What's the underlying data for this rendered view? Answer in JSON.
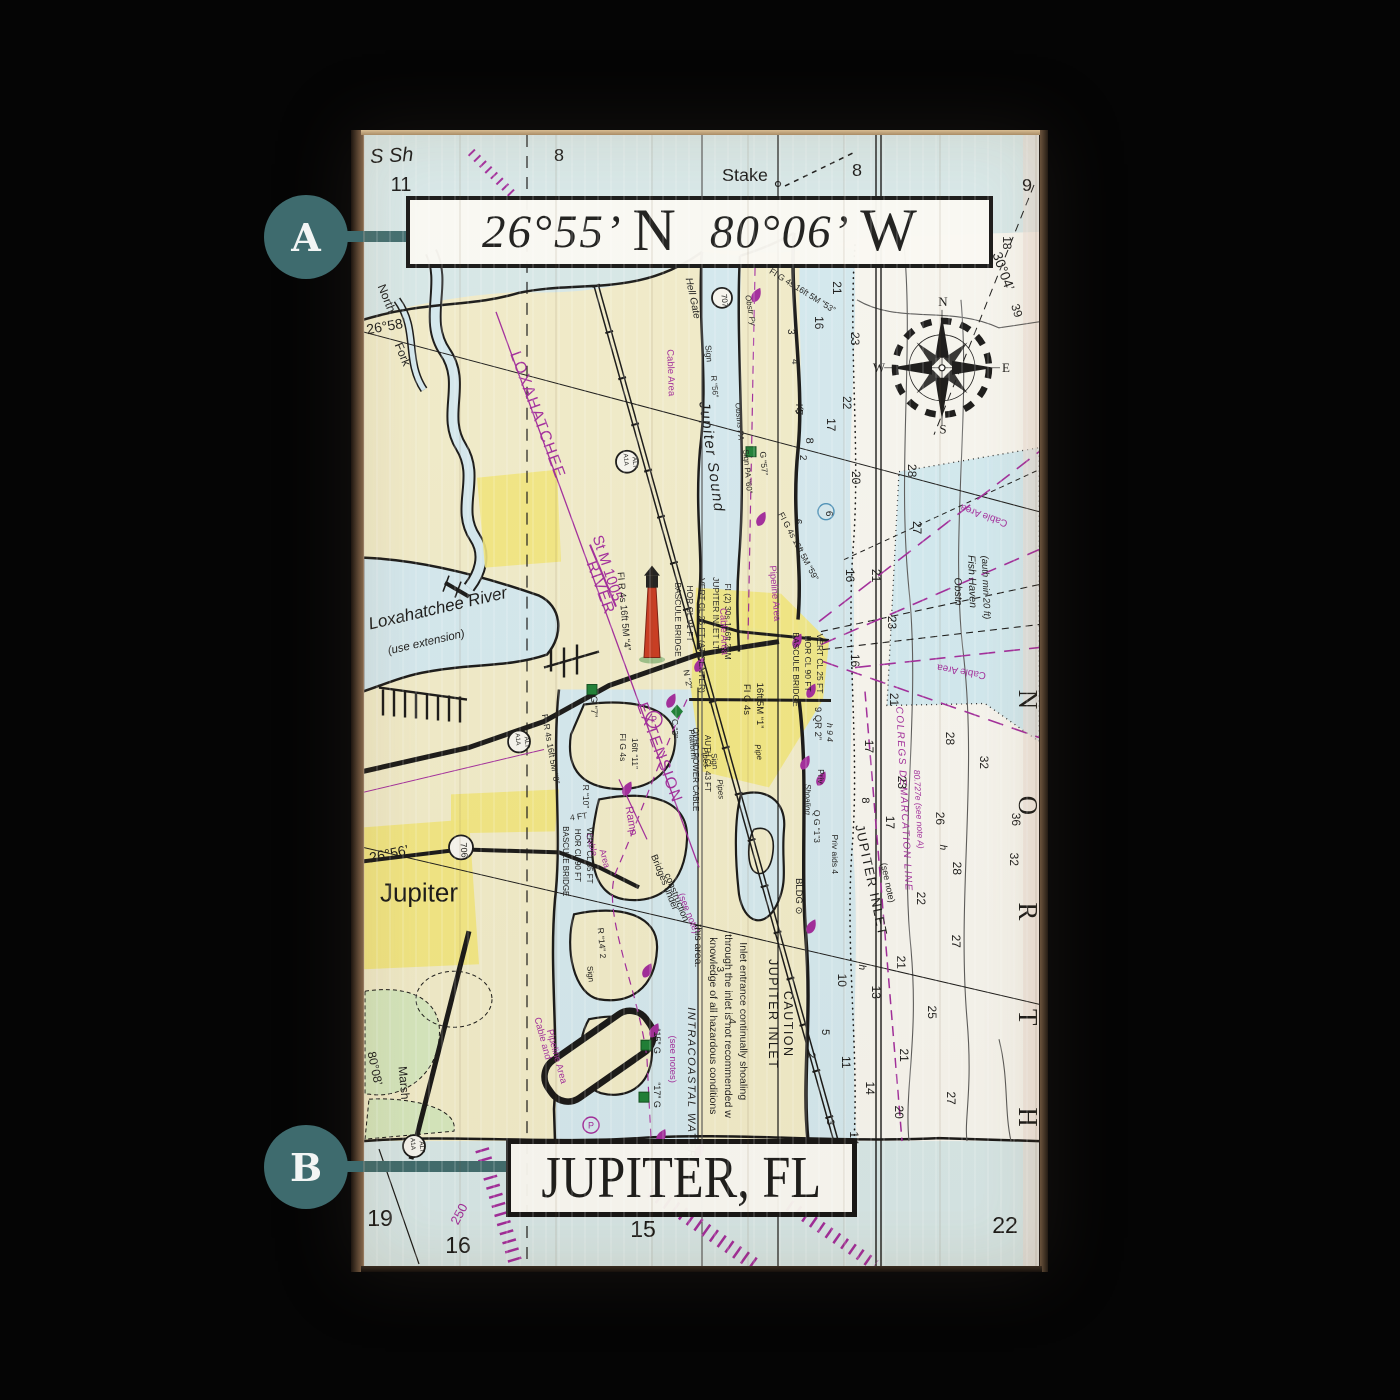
{
  "scene": {
    "background": "#050505"
  },
  "callouts": {
    "color": "#3E6B6E",
    "a": {
      "label": "A"
    },
    "b": {
      "label": "B"
    }
  },
  "banners": {
    "coordinates": {
      "latitude": "26°55’",
      "latitude_hemisphere": "N",
      "longitude": "80°06’",
      "longitude_hemisphere": "W"
    },
    "city": "JUPITER, FL"
  },
  "chart": {
    "colors": {
      "land": "#f1ecca",
      "water": "#d7e8e9",
      "shallow": "#d4e9f0",
      "white-field": "#f7f6f0",
      "yellow": "#f2e77c",
      "marsh": "#d6e8bf",
      "cable-cyan": "#cfeaf2",
      "magenta": "#a12a9c",
      "ink": "#161616",
      "lighthouse-red": "#c9381f",
      "buoy-green": "#1b7f35",
      "callout": "#3E6B6E"
    },
    "labels": [
      [
        "S Sh",
        393,
        162,
        -3,
        20,
        "i"
      ],
      [
        "11",
        402,
        191,
        0,
        20,
        ""
      ],
      [
        "8",
        560,
        161,
        0,
        18,
        ""
      ],
      [
        "Stake",
        746,
        181,
        0,
        18,
        ""
      ],
      [
        "8",
        858,
        176,
        0,
        18,
        ""
      ],
      [
        "9",
        1028,
        191,
        0,
        18,
        ""
      ],
      [
        "18",
        1004,
        243,
        90,
        12,
        ""
      ],
      [
        "30°04’",
        1000,
        273,
        70,
        14,
        ""
      ],
      [
        "39",
        1014,
        312,
        72,
        12,
        ""
      ],
      [
        "26°58’",
        388,
        331,
        -10,
        14,
        ""
      ],
      [
        "North",
        384,
        300,
        68,
        12,
        ""
      ],
      [
        "Fork",
        400,
        356,
        68,
        12,
        ""
      ],
      [
        "Hell Gate",
        691,
        299,
        78,
        10,
        "i"
      ],
      [
        "707",
        723,
        301,
        85,
        8,
        ""
      ],
      [
        "Obstr Py",
        749,
        311,
        80,
        8,
        "i"
      ],
      [
        "Sign",
        707,
        354,
        85,
        8.5,
        ""
      ],
      [
        "R “56”",
        713,
        387,
        85,
        8,
        ""
      ],
      [
        "Obstns PA",
        738,
        422,
        85,
        8,
        "i"
      ],
      [
        "FI G 4s 16ft 5M “53”",
        802,
        293,
        32,
        8.5,
        ""
      ],
      [
        "Cable Area",
        669,
        373,
        88,
        9.5,
        "p"
      ],
      [
        "Jupiter Sound",
        708,
        458,
        82,
        15,
        "i ls"
      ],
      [
        "Sign PA “60”",
        746,
        472,
        85,
        8,
        ""
      ],
      [
        "G “57”",
        762,
        464,
        85,
        8.5,
        ""
      ],
      [
        "Ky",
        798,
        410,
        80,
        9.5,
        "i"
      ],
      [
        "3",
        789,
        332,
        90,
        10,
        ""
      ],
      [
        "4",
        793,
        362,
        90,
        10,
        ""
      ],
      [
        "5",
        797,
        412,
        90,
        10,
        ""
      ],
      [
        "2",
        801,
        458,
        90,
        10,
        ""
      ],
      [
        "6",
        796,
        522,
        90,
        10,
        ""
      ],
      [
        "16",
        816,
        323,
        90,
        12,
        ""
      ],
      [
        "21",
        834,
        288,
        90,
        12,
        ""
      ],
      [
        "23",
        852,
        339,
        90,
        12,
        ""
      ],
      [
        "22",
        844,
        403,
        90,
        12,
        ""
      ],
      [
        "17",
        828,
        425,
        90,
        12,
        ""
      ],
      [
        "8",
        807,
        441,
        90,
        11,
        ""
      ],
      [
        "20",
        853,
        478,
        90,
        12,
        ""
      ],
      [
        "28",
        909,
        471,
        90,
        12,
        ""
      ],
      [
        "27",
        914,
        528,
        90,
        12,
        ""
      ],
      [
        "FI G 4s 16ft 5M “59”",
        797,
        548,
        62,
        8.5,
        ""
      ],
      [
        "16",
        847,
        576,
        90,
        12,
        ""
      ],
      [
        "21",
        873,
        576,
        90,
        12,
        ""
      ],
      [
        "23",
        889,
        623,
        90,
        12,
        ""
      ],
      [
        "16",
        852,
        661,
        90,
        12,
        ""
      ],
      [
        "21",
        891,
        700,
        90,
        12,
        ""
      ],
      [
        "6",
        827,
        514,
        90,
        10,
        ""
      ],
      [
        "Cable Area",
        986,
        513,
        200,
        10,
        "p"
      ],
      [
        "Cable Area",
        963,
        669,
        190,
        10,
        "p"
      ],
      [
        "Obstn",
        956,
        592,
        88,
        10.5,
        "i"
      ],
      [
        "Fish Haven",
        970,
        582,
        88,
        10.5,
        "i"
      ],
      [
        "(auth min 20 ft)",
        984,
        588,
        88,
        9.5,
        "i"
      ],
      [
        "COLREGS DEMARCATION LINE",
        902,
        800,
        87,
        10,
        "pi ls"
      ],
      [
        "80.727e (see note A)",
        917,
        810,
        87,
        8.5,
        "pi"
      ],
      [
        "JUPITER INLET",
        868,
        882,
        78,
        13,
        "ls"
      ],
      [
        "(see note)",
        886,
        884,
        78,
        9,
        ""
      ],
      [
        "32",
        981,
        763,
        90,
        12,
        ""
      ],
      [
        "28",
        947,
        739,
        90,
        12,
        ""
      ],
      [
        "26",
        937,
        819,
        90,
        12,
        ""
      ],
      [
        "h",
        941,
        848,
        90,
        10,
        "i"
      ],
      [
        "28",
        954,
        869,
        90,
        12,
        ""
      ],
      [
        "22",
        918,
        899,
        90,
        12,
        ""
      ],
      [
        "17",
        887,
        823,
        90,
        12,
        ""
      ],
      [
        "17",
        866,
        747,
        90,
        12,
        ""
      ],
      [
        "23",
        899,
        783,
        90,
        12,
        ""
      ],
      [
        "8",
        863,
        801,
        90,
        11,
        ""
      ],
      [
        "36",
        1013,
        820,
        90,
        12,
        ""
      ],
      [
        "32",
        1011,
        860,
        90,
        12,
        ""
      ],
      [
        "27",
        953,
        942,
        90,
        12,
        ""
      ],
      [
        "21",
        898,
        963,
        90,
        12,
        ""
      ],
      [
        "13",
        873,
        993,
        90,
        12,
        ""
      ],
      [
        "10",
        839,
        981,
        90,
        12,
        ""
      ],
      [
        "h",
        860,
        968,
        90,
        10,
        "i"
      ],
      [
        "25",
        929,
        1013,
        90,
        12,
        ""
      ],
      [
        "11",
        843,
        1063,
        90,
        12,
        ""
      ],
      [
        "14",
        867,
        1089,
        90,
        12,
        ""
      ],
      [
        "21",
        901,
        1056,
        90,
        12,
        ""
      ],
      [
        "20",
        896,
        1113,
        90,
        12,
        ""
      ],
      [
        "27",
        948,
        1099,
        90,
        12,
        ""
      ],
      [
        "5",
        823,
        1033,
        90,
        11,
        ""
      ],
      [
        "2",
        809,
        1056,
        90,
        11,
        ""
      ],
      [
        "3",
        828,
        1123,
        90,
        11,
        ""
      ],
      [
        "14",
        851,
        1139,
        90,
        12,
        ""
      ],
      [
        "N",
        1020,
        700,
        90,
        27,
        "sf"
      ],
      [
        "O",
        1020,
        806,
        90,
        27,
        "sf"
      ],
      [
        "R",
        1020,
        912,
        90,
        27,
        "sf"
      ],
      [
        "T",
        1020,
        1018,
        90,
        27,
        "sf"
      ],
      [
        "H",
        1020,
        1118,
        90,
        27,
        "sf"
      ],
      [
        "N",
        944,
        306,
        0,
        13,
        "sf"
      ],
      [
        "E",
        1007,
        372,
        0,
        13,
        "sf"
      ],
      [
        "S",
        944,
        434,
        0,
        13,
        "sf"
      ],
      [
        "W",
        880,
        372,
        0,
        13,
        "sf"
      ],
      [
        "Loxahatchee River",
        440,
        614,
        -13,
        17,
        "i"
      ],
      [
        "(use extension)",
        428,
        646,
        -13,
        11.5,
        "i"
      ],
      [
        "LOXAHATCHEE",
        534,
        417,
        70,
        16,
        "p ls"
      ],
      [
        "RIVER",
        597,
        590,
        70,
        16,
        "p ls"
      ],
      [
        "EXTENSION",
        656,
        755,
        70,
        16,
        "p ls"
      ],
      [
        "St M 1005",
        604,
        570,
        72,
        15,
        "p"
      ],
      [
        "26°56’",
        391,
        859,
        -12,
        14,
        ""
      ],
      [
        "Jupiter",
        420,
        902,
        0,
        26,
        ""
      ],
      [
        "706",
        462,
        851,
        85,
        9,
        ""
      ],
      [
        "A1A",
        517,
        740,
        85,
        6.5,
        ""
      ],
      [
        "ALT",
        526,
        743,
        85,
        6.5,
        ""
      ],
      [
        "A1A",
        625,
        460,
        85,
        6.5,
        ""
      ],
      [
        "ALT",
        634,
        463,
        85,
        6.5,
        ""
      ],
      [
        "A1A",
        412,
        1145,
        85,
        6.5,
        ""
      ],
      [
        "ALT",
        421,
        1148,
        85,
        6.5,
        ""
      ],
      [
        "FI R 4s 16ft 5M “8”",
        549,
        750,
        80,
        8.5,
        ""
      ],
      [
        "FI R 4s 16ft 5M “4”",
        622,
        612,
        85,
        9.5,
        ""
      ],
      [
        "BASCULE BRIDGE",
        676,
        620,
        90,
        8.5,
        ""
      ],
      [
        "HOR CL 91 FT",
        688,
        614,
        90,
        8.5,
        ""
      ],
      [
        "VERT CL 26 FT (AT CENTER)",
        700,
        636,
        90,
        8.5,
        ""
      ],
      [
        "JUPITER INLET LT",
        714,
        614,
        90,
        8.5,
        ""
      ],
      [
        "FI (2) 30s 146ft 25M",
        726,
        622,
        90,
        8.5,
        ""
      ],
      [
        "BASCULE BRIDGE",
        794,
        670,
        90,
        8.5,
        ""
      ],
      [
        "HOR CL 90 FT",
        806,
        664,
        90,
        8.5,
        ""
      ],
      [
        "VERT CL 25 FT",
        818,
        664,
        90,
        8.5,
        ""
      ],
      [
        "FI G 4s",
        745,
        700,
        90,
        9.5,
        ""
      ],
      [
        "16ft 5M “1”",
        758,
        706,
        90,
        9.5,
        ""
      ],
      [
        "Pipeline Area",
        773,
        594,
        85,
        9.5,
        "p"
      ],
      [
        "Cable Area",
        722,
        632,
        88,
        9.5,
        "p"
      ],
      [
        "N “2”",
        686,
        680,
        80,
        8.5,
        ""
      ],
      [
        "G “7”",
        592,
        707,
        90,
        9.5,
        ""
      ],
      [
        "FI G 4s",
        621,
        748,
        90,
        8.5,
        ""
      ],
      [
        "16ft “11”",
        633,
        754,
        90,
        8.5,
        ""
      ],
      [
        "R “10”",
        584,
        797,
        90,
        8.5,
        ""
      ],
      [
        "C “3”",
        673,
        729,
        90,
        8.5,
        ""
      ],
      [
        "Platform",
        691,
        745,
        85,
        8,
        ""
      ],
      [
        "Pipes",
        704,
        758,
        85,
        8,
        "i"
      ],
      [
        "Sign",
        713,
        762,
        85,
        8,
        ""
      ],
      [
        "Pipes",
        719,
        790,
        85,
        8,
        "i"
      ],
      [
        "Pipe",
        757,
        753,
        80,
        8,
        "i"
      ],
      [
        "9 QR 2”",
        816,
        724,
        90,
        9.5,
        ""
      ],
      [
        "h 9 4",
        828,
        733,
        90,
        8.5,
        "i"
      ],
      [
        "Priv",
        819,
        777,
        90,
        8.5,
        ""
      ],
      [
        "Q G “1”3",
        815,
        827,
        90,
        8.5,
        ""
      ],
      [
        "Shoaling",
        806,
        800,
        90,
        8,
        "i"
      ],
      [
        "Priv aids 4",
        833,
        855,
        90,
        8.5,
        ""
      ],
      [
        "Ramp",
        629,
        822,
        80,
        11,
        "p"
      ],
      [
        "4 FT",
        580,
        820,
        -8,
        8.5,
        ""
      ],
      [
        "Cable",
        590,
        846,
        75,
        9,
        "p"
      ],
      [
        "Area",
        603,
        860,
        75,
        9,
        "p"
      ],
      [
        "BASCULE BRIDGE",
        564,
        862,
        90,
        8,
        ""
      ],
      [
        "HOR CL 90 FT",
        576,
        856,
        90,
        8,
        ""
      ],
      [
        "VERT CL 35 FT",
        588,
        856,
        90,
        8,
        ""
      ],
      [
        "Bridges under",
        663,
        884,
        68,
        9.5,
        ""
      ],
      [
        "construction",
        675,
        899,
        68,
        9.5,
        ""
      ],
      [
        "(see note)",
        687,
        915,
        68,
        9.5,
        "p"
      ],
      [
        "OVHD POWER CABLE",
        694,
        770,
        90,
        8,
        ""
      ],
      [
        "AUTH CL 43 FT",
        706,
        764,
        90,
        8,
        ""
      ],
      [
        "BLDG ⊙",
        797,
        897,
        90,
        9.5,
        ""
      ],
      [
        "JUPITER INLET",
        770,
        1015,
        90,
        12.5,
        "ls"
      ],
      [
        "CAUTION",
        785,
        1025,
        90,
        12.5,
        "ls"
      ],
      [
        "Inlet entrance continually shoaling",
        741,
        943,
        90,
        10.5,
        "as"
      ],
      [
        "through the inlet is not recommended w",
        726,
        935,
        90,
        10.5,
        "as"
      ],
      [
        "knowledge of all hazardous conditions",
        711,
        938,
        90,
        10.5,
        "as"
      ],
      [
        "this area.",
        696,
        925,
        90,
        10.5,
        "as"
      ],
      [
        "INTRACOASTAL WATERWAY",
        689,
        1008,
        90,
        11,
        "i ls as"
      ],
      [
        "(see notes)",
        671,
        1060,
        90,
        9.5,
        "p"
      ],
      [
        "Cable and",
        541,
        1040,
        75,
        9.5,
        "p"
      ],
      [
        "Pipeline Area",
        555,
        1058,
        75,
        9.5,
        "p"
      ],
      [
        "R “14” 2",
        600,
        944,
        85,
        8.5,
        ""
      ],
      [
        "Sign",
        589,
        975,
        85,
        8,
        ""
      ],
      [
        "“15” G",
        655,
        1042,
        90,
        9,
        ""
      ],
      [
        "“17” G",
        655,
        1096,
        90,
        9,
        ""
      ],
      [
        "4",
        730,
        1022,
        90,
        10,
        ""
      ],
      [
        "3",
        718,
        970,
        90,
        10,
        ""
      ],
      [
        "Marsh",
        401,
        1084,
        85,
        12,
        ""
      ],
      [
        "80°08’",
        372,
        1070,
        78,
        12,
        ""
      ],
      [
        "19",
        381,
        1227,
        0,
        23,
        ""
      ],
      [
        "16",
        459,
        1254,
        0,
        23,
        ""
      ],
      [
        "15",
        644,
        1238,
        0,
        23,
        ""
      ],
      [
        "22",
        1006,
        1234,
        0,
        23,
        ""
      ],
      [
        "250",
        464,
        1217,
        -62,
        13,
        "p"
      ]
    ],
    "marks": [
      [
        "gsq",
        752,
        452
      ],
      [
        "gsq",
        593,
        690
      ],
      [
        "gsq",
        647,
        1046
      ],
      [
        "gsq",
        645,
        1098
      ],
      [
        "gdia",
        678,
        712
      ],
      [
        "tear",
        757,
        296
      ],
      [
        "tear",
        762,
        520
      ],
      [
        "tear",
        700,
        666
      ],
      [
        "tear",
        672,
        702
      ],
      [
        "tear",
        798,
        642
      ],
      [
        "tear",
        812,
        692
      ],
      [
        "tear",
        806,
        764
      ],
      [
        "tear",
        822,
        780
      ],
      [
        "tear",
        628,
        790
      ],
      [
        "tear",
        648,
        972
      ],
      [
        "tear",
        655,
        1032
      ],
      [
        "tear",
        662,
        1138
      ],
      [
        "tear",
        700,
        1152
      ],
      [
        "tear",
        812,
        928
      ],
      [
        "pcircle",
        655,
        720
      ],
      [
        "pcircle",
        592,
        1126
      ],
      [
        "shield",
        723,
        298,
        10
      ],
      [
        "shield",
        462,
        848,
        12
      ],
      [
        "shield",
        520,
        742,
        11
      ],
      [
        "shield",
        628,
        462,
        11
      ],
      [
        "shield",
        415,
        1147,
        11
      ],
      [
        "bc",
        827,
        512
      ]
    ]
  }
}
